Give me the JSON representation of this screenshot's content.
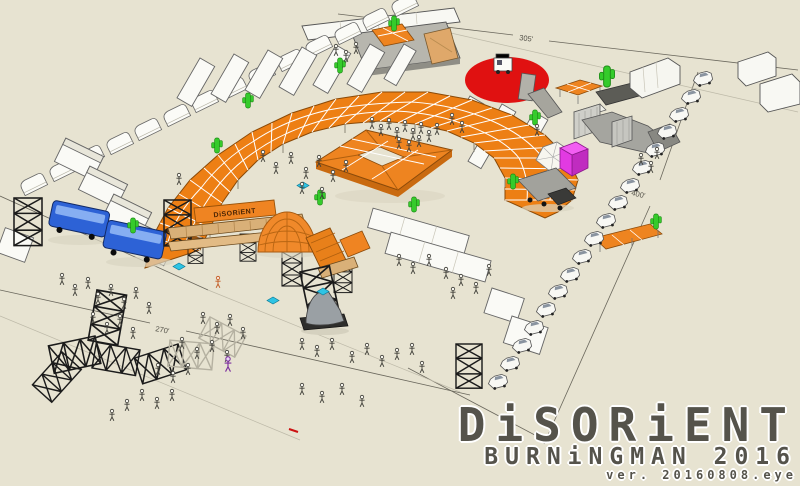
{
  "logo": {
    "title": "DiSORiENT",
    "subtitle": "BURNiNGMAN 2016",
    "version": "ver. 20160808.eye"
  },
  "dimension_labels": {
    "top": "305'",
    "right": "400'",
    "bottom_left": "270'"
  },
  "gate_banner": {
    "text": "DiSORiENT"
  },
  "scene": {
    "description": "3D sketch-style site plan of the Disorient camp at Burning Man 2016",
    "colors": {
      "ground": "#e7e3d1",
      "canopy_orange": "#ed7f14",
      "red_circle": "#e01111",
      "bus_blue": "#2d62d6",
      "magenta_box": "#e23ae2",
      "cactus_green": "#35cb2b",
      "cyan_item": "#2ec4e4",
      "truss_black": "#1b1b1b",
      "logo_gray": "#55534b"
    }
  }
}
